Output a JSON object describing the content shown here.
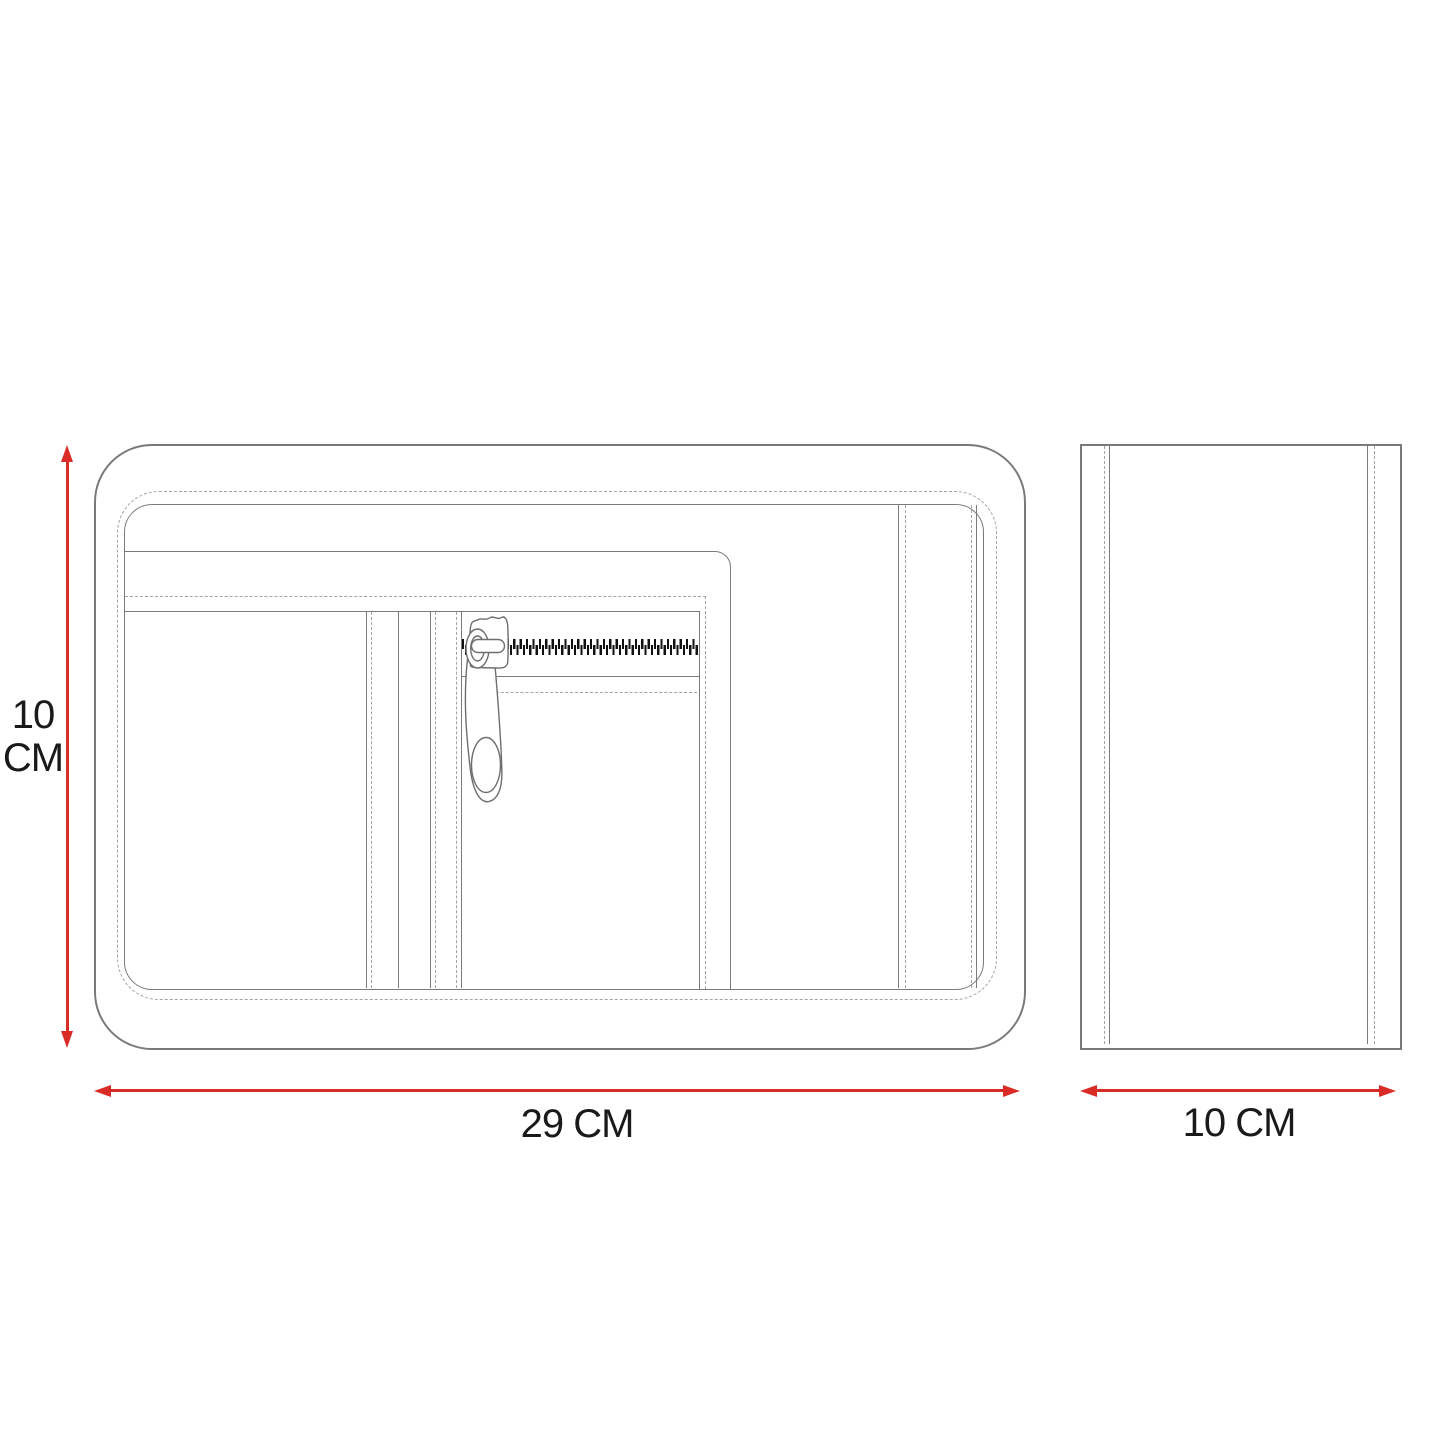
{
  "drawing": {
    "type": "product-dimension-diagram",
    "subject": "pouch technical drawing, front and side views"
  },
  "colors": {
    "accent": "#db2b27",
    "line": "#7a7a7a",
    "stitch": "#a3a3a3",
    "teeth": "#111111",
    "text": "#1a1a1a",
    "bg": "#ffffff"
  },
  "icons": {
    "zipper_pull": "zipper-pull-icon",
    "arrow_up": "arrowhead-up-icon",
    "arrow_down": "arrowhead-down-icon",
    "arrow_left": "arrowhead-left-icon",
    "arrow_right": "arrowhead-right-icon"
  },
  "dimensions": {
    "height": {
      "line1": "10",
      "line2": "CM"
    },
    "width": {
      "label": "29 CM"
    },
    "depth": {
      "label": "10 CM"
    }
  }
}
